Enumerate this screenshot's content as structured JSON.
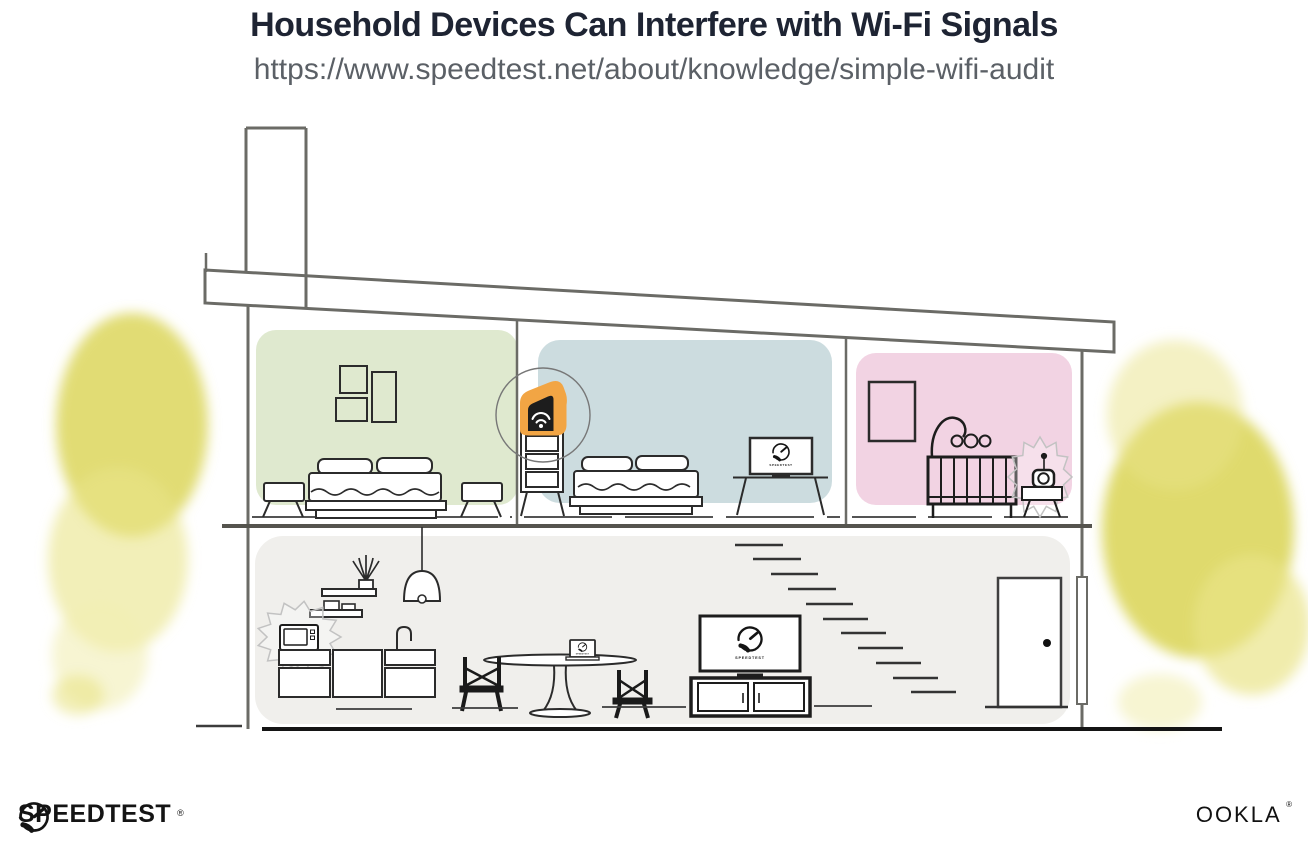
{
  "header": {
    "title": "Household Devices Can Interfere with Wi-Fi Signals",
    "subtitle_url": "https://www.speedtest.net/about/knowledge/simple-wifi-audit"
  },
  "illustration": {
    "screen_label": "SPEEDTEST",
    "colors": {
      "bedroom_green": "#dfe9cf",
      "bedroom_blue": "#ccdcdf",
      "nursery_pink": "#f2d3e3",
      "ground_floor_gray": "#f0efec",
      "router_orange": "#f2a544",
      "foliage_yellow": "#dcd65c",
      "foliage_yellow_light": "#e9e489",
      "foliage_yellow_pale": "#f1eeb4",
      "line_dark": "#2b2b2b",
      "structure_gray": "#6b6b66",
      "interference_gray": "#c2c2c2"
    }
  },
  "footer": {
    "speedtest_logo_text": "SPEEDTEST",
    "speedtest_trademark": "®",
    "ookla_logo_text": "OOKLA",
    "ookla_trademark": "®"
  }
}
